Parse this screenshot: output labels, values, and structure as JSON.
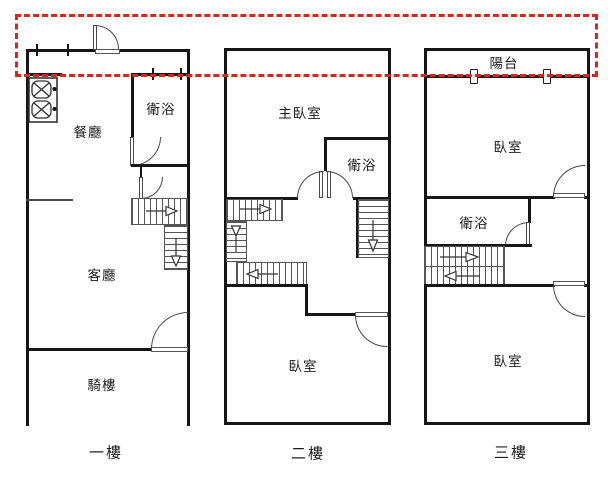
{
  "floors": [
    {
      "name": "一樓",
      "rooms": {
        "dining": "餐廳",
        "bath": "衛浴",
        "living": "客廳",
        "arcade": "騎樓"
      }
    },
    {
      "name": "二樓",
      "rooms": {
        "master": "主臥室",
        "bath": "衛浴",
        "bedroom": "臥室"
      }
    },
    {
      "name": "三樓",
      "rooms": {
        "balcony": "陽台",
        "front_bedroom": "臥室",
        "bath": "衛浴",
        "rear_bedroom": "臥室"
      }
    }
  ],
  "annotation": {
    "highlight_color": "#d9251c",
    "style": "dashed-rectangle"
  },
  "colors": {
    "wall": "#161616",
    "line": "#4a4a4a",
    "background": "#ffffff"
  }
}
